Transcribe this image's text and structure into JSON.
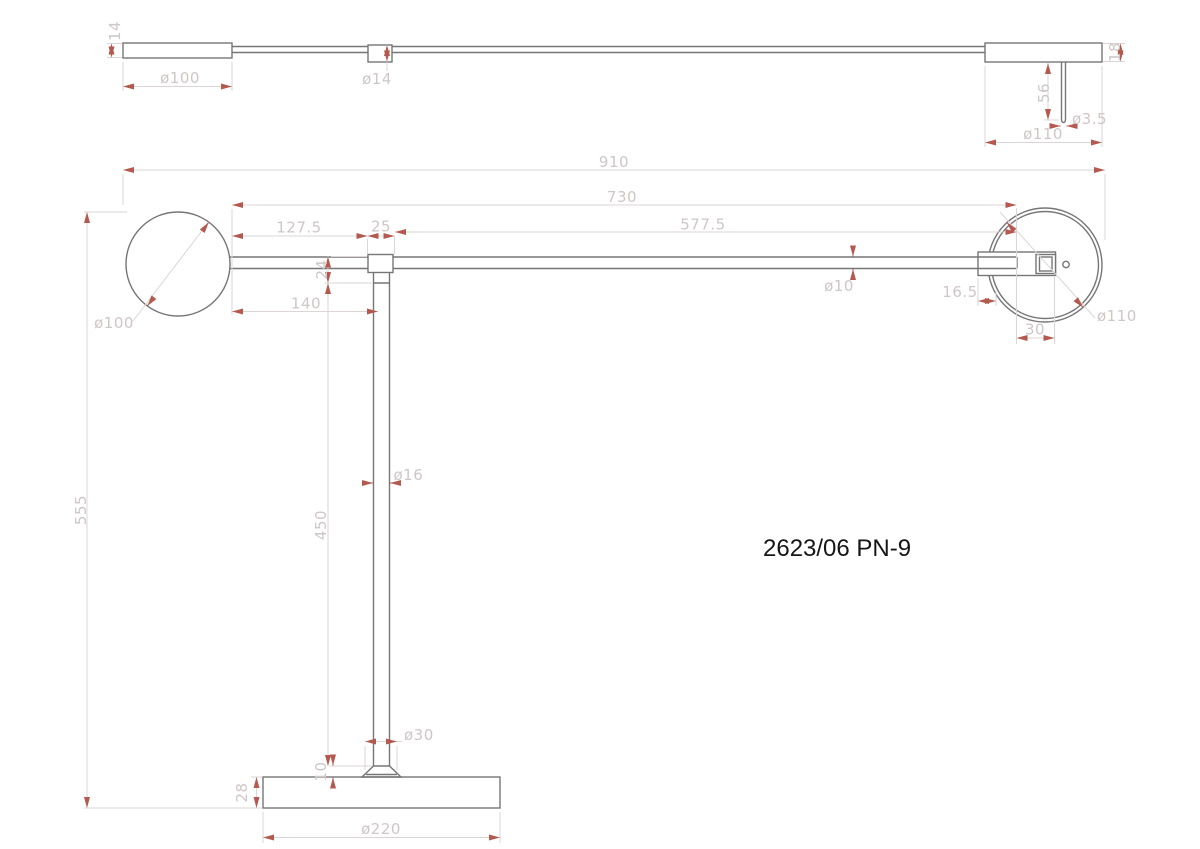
{
  "drawing": {
    "title_code": "2623/06 PN-9",
    "colors": {
      "geometry": "#767676",
      "dimension_line": "#ddd5d5",
      "dimension_text": "#cfc6c6",
      "arrow": "#b4594f",
      "label_text": "#161616",
      "background": "#ffffff"
    },
    "top_view": {
      "dims": {
        "shade_thickness": "14",
        "shade_diameter": "ø100",
        "joint_diameter": "ø14",
        "head_thickness": "18",
        "stem_length": "56",
        "stem_diameter": "ø3.5",
        "head_diameter": "ø110"
      }
    },
    "front_view": {
      "dims": {
        "overall_width": "910",
        "arm_length": "730",
        "arm_right_span": "577.5",
        "arm_left_span": "127.5",
        "joint_width": "25",
        "joint_height": "24",
        "shade_to_pole": "140",
        "shade_diameter": "ø100",
        "arm_diameter": "ø10",
        "head_inset": "16.5",
        "head_diameter": "ø110",
        "head_mount_width": "30",
        "overall_height": "555",
        "pole_diameter": "ø16",
        "pole_length": "450",
        "foot_diameter": "ø30",
        "foot_height": "10",
        "base_thickness": "28",
        "base_diameter": "ø220"
      }
    }
  }
}
